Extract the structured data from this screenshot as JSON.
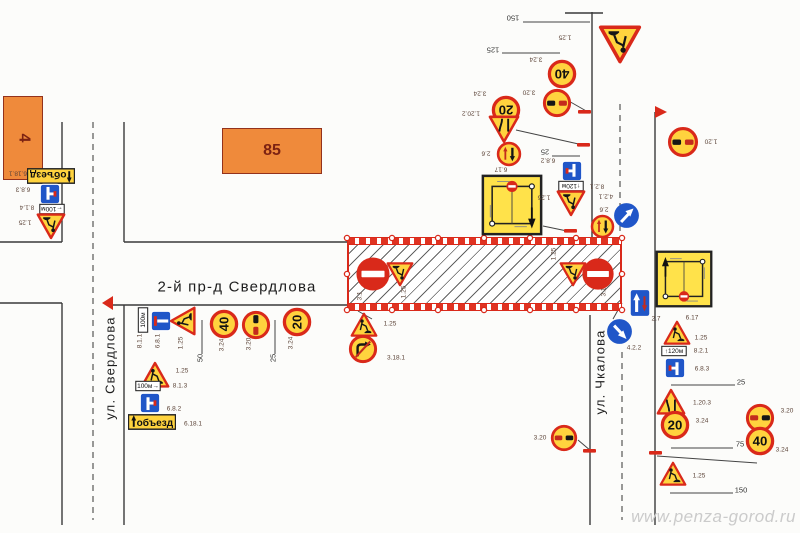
{
  "watermark": "www.penza-gorod.ru",
  "colors": {
    "sign_red": "#D9291A",
    "sign_yellow": "#FFD33E",
    "sign_blue": "#2056C8",
    "road_line": "#3a3a3a",
    "zone_red": "#E03322",
    "building_fill": "#EF8A3B"
  },
  "street_names": [
    {
      "text": "2-й пр-д Свердлова",
      "cx": 237,
      "cy": 287,
      "rot": 0,
      "size": 15
    },
    {
      "text": "ул. Свердлова",
      "cx": 110,
      "cy": 368,
      "rot": -90,
      "size": 13
    },
    {
      "text": "ул. Чкалова",
      "cx": 600,
      "cy": 372,
      "rot": -90,
      "size": 13
    }
  ],
  "buildings": [
    {
      "num": "4",
      "x": 3,
      "y": 96,
      "w": 38,
      "h": 82,
      "num_rot": 90
    },
    {
      "num": "85",
      "x": 222,
      "y": 128,
      "w": 98,
      "h": 44,
      "num_rot": 0
    }
  ],
  "work_zone": {
    "x": 347,
    "y": 238,
    "w": 275,
    "h": 72
  },
  "roads": {
    "solid": [
      [
        62,
        122,
        62,
        242
      ],
      [
        124,
        122,
        124,
        242
      ],
      [
        0,
        242,
        62,
        242
      ],
      [
        0,
        303,
        62,
        303
      ],
      [
        62,
        303,
        62,
        525
      ],
      [
        124,
        305,
        124,
        525
      ],
      [
        124,
        242,
        347,
        242
      ],
      [
        113,
        305,
        347,
        305
      ],
      [
        592,
        12,
        592,
        238
      ],
      [
        655,
        112,
        655,
        525
      ],
      [
        565,
        13,
        603,
        13
      ],
      [
        590,
        315,
        590,
        525
      ]
    ],
    "dashed": [
      [
        93,
        122,
        93,
        520
      ],
      [
        620,
        104,
        620,
        236
      ],
      [
        622,
        352,
        622,
        520
      ]
    ]
  },
  "leaders": [
    [
      560,
      96,
      588,
      112
    ],
    [
      516,
      130,
      583,
      145
    ],
    [
      543,
      226,
      567,
      231
    ],
    [
      622,
      303,
      613,
      319
    ],
    [
      578,
      440,
      591,
      451
    ],
    [
      657,
      456,
      757,
      463
    ],
    [
      358,
      311,
      372,
      319
    ]
  ],
  "ticks": [
    [
      578,
      110
    ],
    [
      577,
      143
    ],
    [
      564,
      229
    ],
    [
      583,
      449
    ],
    [
      649,
      451
    ]
  ],
  "flags": [
    [
      113,
      296,
      113,
      310,
      102,
      303
    ],
    [
      655,
      106,
      655,
      118,
      667,
      112
    ]
  ],
  "zone_dots": [
    [
      347,
      238
    ],
    [
      392,
      238
    ],
    [
      438,
      238
    ],
    [
      484,
      238
    ],
    [
      530,
      238
    ],
    [
      576,
      238
    ],
    [
      622,
      238
    ],
    [
      347,
      310
    ],
    [
      392,
      310
    ],
    [
      438,
      310
    ],
    [
      484,
      310
    ],
    [
      530,
      310
    ],
    [
      576,
      310
    ],
    [
      622,
      310
    ],
    [
      347,
      274
    ],
    [
      622,
      274
    ]
  ],
  "dims": [
    {
      "text": "150",
      "x1": 523,
      "y1": 22,
      "x2": 590,
      "y2": 22,
      "lx": 513,
      "ly": 18,
      "lr": 180
    },
    {
      "text": "125",
      "x1": 502,
      "y1": 53,
      "x2": 560,
      "y2": 53,
      "lx": 493,
      "ly": 50,
      "lr": 180
    },
    {
      "text": "25",
      "x1": 552,
      "y1": 156,
      "x2": 580,
      "y2": 156,
      "lx": 545,
      "ly": 152,
      "lr": 180
    },
    {
      "text": "50",
      "x1": 202,
      "y1": 320,
      "x2": 202,
      "y2": 354,
      "lx": 200,
      "ly": 358,
      "lr": -90
    },
    {
      "text": "25",
      "x1": 275,
      "y1": 320,
      "x2": 275,
      "y2": 354,
      "lx": 273,
      "ly": 358,
      "lr": -90
    },
    {
      "text": "25",
      "x1": 671,
      "y1": 385,
      "x2": 735,
      "y2": 385,
      "lx": 741,
      "ly": 382,
      "lr": 0
    },
    {
      "text": "75",
      "x1": 671,
      "y1": 448,
      "x2": 733,
      "y2": 448,
      "lx": 740,
      "ly": 444,
      "lr": 0
    },
    {
      "text": "150",
      "x1": 670,
      "y1": 493,
      "x2": 733,
      "y2": 493,
      "lx": 741,
      "ly": 490,
      "lr": 0
    }
  ],
  "signs": [
    {
      "t": "pdetour",
      "x": 27,
      "y": 152,
      "s": 48,
      "r": 180,
      "txt": "объезд",
      "code": "6.18.1",
      "lx": 18,
      "ly": 173,
      "lr": 180
    },
    {
      "t": "b683",
      "x": 39,
      "y": 183,
      "s": 22,
      "r": 180,
      "code": "6.8.3",
      "lx": 23,
      "ly": 189,
      "lr": 180
    },
    {
      "t": "plate",
      "x": 39,
      "y": 196,
      "s": 26,
      "r": 180,
      "txt": "←100м",
      "code": "8.1.4",
      "lx": 27,
      "ly": 207,
      "lr": 180
    },
    {
      "t": "tri125",
      "x": 36,
      "y": 211,
      "s": 30,
      "r": 180,
      "code": "1.25",
      "lx": 25,
      "ly": 222,
      "lr": 180
    },
    {
      "t": "tri125",
      "x": 598,
      "y": 22,
      "s": 44,
      "r": 180,
      "code": "1.25",
      "lx": 565,
      "ly": 37,
      "lr": 180
    },
    {
      "t": "climit",
      "txt": "40",
      "x": 547,
      "y": 59,
      "s": 30,
      "r": 180,
      "code": "3.24",
      "lx": 536,
      "ly": 59,
      "lr": 180
    },
    {
      "t": "c320",
      "x": 542,
      "y": 88,
      "s": 30,
      "r": 180,
      "code": "3.20",
      "lx": 529,
      "ly": 92,
      "lr": 180
    },
    {
      "t": "climit",
      "txt": "20",
      "x": 491,
      "y": 95,
      "s": 30,
      "r": 180,
      "code": "3.24",
      "lx": 480,
      "ly": 93,
      "lr": 180
    },
    {
      "t": "tri1202",
      "x": 488,
      "y": 113,
      "s": 32,
      "r": 180,
      "code": "1.20.2",
      "lx": 471,
      "ly": 113,
      "lr": 180
    },
    {
      "t": "c26",
      "x": 496,
      "y": 141,
      "s": 26,
      "r": 180,
      "code": "2.6",
      "lx": 486,
      "ly": 153,
      "lr": 180
    },
    {
      "t": "b682",
      "x": 561,
      "y": 160,
      "s": 22,
      "r": 180,
      "code": "6.8.2",
      "lx": 548,
      "ly": 160,
      "lr": 180
    },
    {
      "t": "plate",
      "x": 558,
      "y": 173,
      "s": 26,
      "r": 180,
      "txt": "↑120м",
      "code": "8.2.1",
      "lx": 597,
      "ly": 186,
      "lr": 180
    },
    {
      "t": "tri125",
      "x": 556,
      "y": 188,
      "s": 30,
      "r": 180,
      "code": "1.25",
      "lx": 544,
      "ly": 197,
      "lr": 180
    },
    {
      "t": "s617",
      "x": 481,
      "y": 174,
      "s": 62,
      "r": 180,
      "code": "6.17",
      "lx": 501,
      "ly": 169,
      "lr": 180
    },
    {
      "t": "c26",
      "x": 590,
      "y": 214,
      "s": 25,
      "r": 180,
      "code": "2.6",
      "lx": 604,
      "ly": 209,
      "lr": 180
    },
    {
      "t": "c42ur",
      "x": 613,
      "y": 202,
      "s": 27,
      "r": 0,
      "code": "4.2.1",
      "lx": 606,
      "ly": 196,
      "lr": 180
    },
    {
      "t": "c320",
      "x": 667,
      "y": 126,
      "s": 32,
      "r": 180,
      "code": "1.20",
      "lx": 711,
      "ly": 141,
      "lr": 180
    },
    {
      "t": "plate",
      "x": 130,
      "y": 307,
      "s": 26,
      "r": -90,
      "txt": "100м",
      "code": "8.1.1",
      "lx": 140,
      "ly": 341,
      "lr": -90
    },
    {
      "t": "b681",
      "x": 150,
      "y": 310,
      "s": 22,
      "r": -90,
      "code": "6.8.1",
      "lx": 158,
      "ly": 341,
      "lr": -90
    },
    {
      "t": "tri125",
      "x": 168,
      "y": 306,
      "s": 30,
      "r": -90,
      "code": "1.25",
      "lx": 181,
      "ly": 343,
      "lr": -90
    },
    {
      "t": "climit",
      "txt": "40",
      "x": 209,
      "y": 309,
      "s": 30,
      "r": -90,
      "code": "3.24",
      "lx": 222,
      "ly": 345,
      "lr": -90
    },
    {
      "t": "c320",
      "x": 241,
      "y": 310,
      "s": 30,
      "r": -90,
      "code": "3.20",
      "lx": 249,
      "ly": 344,
      "lr": -90
    },
    {
      "t": "climit",
      "txt": "20",
      "x": 282,
      "y": 307,
      "s": 30,
      "r": -90,
      "code": "3.24",
      "lx": 291,
      "ly": 343,
      "lr": -90
    },
    {
      "t": "tri125",
      "x": 140,
      "y": 360,
      "s": 30,
      "r": 0,
      "code": "1.25",
      "lx": 182,
      "ly": 371,
      "lr": 0
    },
    {
      "t": "plate",
      "x": 135,
      "y": 373,
      "s": 26,
      "r": 0,
      "txt": "100м→",
      "code": "8.1.3",
      "lx": 180,
      "ly": 386,
      "lr": 0
    },
    {
      "t": "b682",
      "x": 139,
      "y": 392,
      "s": 22,
      "r": 0,
      "code": "6.8.2",
      "lx": 174,
      "ly": 409,
      "lr": 0
    },
    {
      "t": "pdetour",
      "x": 128,
      "y": 398,
      "s": 48,
      "r": 0,
      "txt": "объезд",
      "code": "6.18.1",
      "lx": 193,
      "ly": 424,
      "lr": 0
    },
    {
      "t": "c31",
      "x": 355,
      "y": 256,
      "s": 36,
      "r": 0,
      "code": "3.1",
      "lx": 360,
      "ly": 296,
      "lr": -90
    },
    {
      "t": "tri125",
      "x": 386,
      "y": 260,
      "s": 28,
      "r": 180,
      "code": "1.25",
      "lx": 404,
      "ly": 292,
      "lr": -90
    },
    {
      "t": "tri125",
      "x": 559,
      "y": 260,
      "s": 28,
      "r": 180,
      "code": "1.25",
      "lx": 554,
      "ly": 254,
      "lr": -90
    },
    {
      "t": "c31",
      "x": 581,
      "y": 257,
      "s": 34,
      "r": 0,
      "code": "3.1",
      "lx": 604,
      "ly": 292,
      "lr": -90
    },
    {
      "t": "tri125",
      "x": 350,
      "y": 311,
      "s": 28,
      "r": 0,
      "code": "1.25",
      "lx": 390,
      "ly": 324,
      "lr": 0
    },
    {
      "t": "c3181",
      "x": 348,
      "y": 334,
      "s": 30,
      "r": 0,
      "code": "3.18.1",
      "lx": 396,
      "ly": 358,
      "lr": 0
    },
    {
      "t": "c320",
      "x": 550,
      "y": 424,
      "s": 28,
      "r": 0,
      "code": "3.20",
      "lx": 540,
      "ly": 438,
      "lr": 0
    },
    {
      "t": "s27",
      "x": 626,
      "y": 289,
      "s": 28,
      "r": 0,
      "code": "2.7",
      "lx": 656,
      "ly": 319,
      "lr": 0
    },
    {
      "t": "c42dr",
      "x": 606,
      "y": 318,
      "s": 27,
      "r": 0,
      "code": "4.2.2",
      "lx": 634,
      "ly": 348,
      "lr": 0
    },
    {
      "t": "s617",
      "x": 655,
      "y": 250,
      "s": 58,
      "r": 0,
      "code": "6.17",
      "lx": 692,
      "ly": 318,
      "lr": 0
    },
    {
      "t": "tri125",
      "x": 663,
      "y": 319,
      "s": 28,
      "r": 0,
      "code": "1.25",
      "lx": 701,
      "ly": 338,
      "lr": 0
    },
    {
      "t": "plate",
      "x": 661,
      "y": 338,
      "s": 26,
      "r": 0,
      "txt": "↑120м",
      "code": "8.2.1",
      "lx": 701,
      "ly": 351,
      "lr": 0
    },
    {
      "t": "b683",
      "x": 664,
      "y": 357,
      "s": 22,
      "r": 0,
      "code": "6.8.3",
      "lx": 702,
      "ly": 369,
      "lr": 0
    },
    {
      "t": "tri1203",
      "x": 656,
      "y": 387,
      "s": 30,
      "r": 0,
      "code": "1.20.3",
      "lx": 702,
      "ly": 403,
      "lr": 0
    },
    {
      "t": "climit",
      "txt": "20",
      "x": 660,
      "y": 410,
      "s": 30,
      "r": 0,
      "code": "3.24",
      "lx": 702,
      "ly": 421,
      "lr": 0
    },
    {
      "t": "c320",
      "x": 745,
      "y": 403,
      "s": 30,
      "r": 0,
      "code": "3.20",
      "lx": 787,
      "ly": 411,
      "lr": 0
    },
    {
      "t": "climit",
      "txt": "40",
      "x": 745,
      "y": 426,
      "s": 30,
      "r": 0,
      "code": "3.24",
      "lx": 782,
      "ly": 450,
      "lr": 0
    },
    {
      "t": "tri125",
      "x": 659,
      "y": 460,
      "s": 28,
      "r": 0,
      "code": "1.25",
      "lx": 699,
      "ly": 476,
      "lr": 0
    }
  ]
}
